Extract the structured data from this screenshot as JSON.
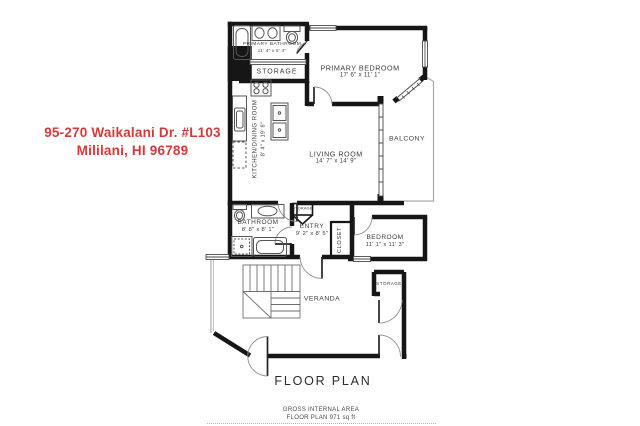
{
  "canvas": {
    "width": 640,
    "height": 426,
    "background": "#ffffff"
  },
  "address": {
    "line1": "95-270 Waikalani Dr. #L103",
    "line2": "Mililani, HI 96789",
    "color": "#d23b3b"
  },
  "plan_title": "FLOOR PLAN",
  "footer": {
    "line1": "GROSS INTERNAL AREA",
    "line2": "FLOOR PLAN 971 sq ft"
  },
  "colors": {
    "wall": "#161616",
    "fixture_stroke": "#555555",
    "label_text": "#3c3c3c",
    "address_red": "#d23b3b"
  },
  "rooms": [
    {
      "name": "PRIMARY BATHROOM",
      "dims": "11' 4\" x 5' 4\""
    },
    {
      "name": "STORAGE",
      "dims": ""
    },
    {
      "name": "PRIMARY BEDROOM",
      "dims": "17' 6\" x 11' 1\""
    },
    {
      "name": "KITCHEN/DINING ROOM",
      "dims": "8' 4\" x 19' 8\""
    },
    {
      "name": "LIVING ROOM",
      "dims": "14' 7\" x 14' 9\""
    },
    {
      "name": "BALCONY",
      "dims": ""
    },
    {
      "name": "BATHROOM",
      "dims": "8' 8\" x 8' 1\""
    },
    {
      "name": "ENTRY",
      "dims": "9' 2\" x 8' 5\""
    },
    {
      "name": "CLOSET",
      "dims": ""
    },
    {
      "name": "BEDROOM",
      "dims": "11' 1\" x 11' 3\""
    },
    {
      "name": "VERANDA",
      "dims": ""
    },
    {
      "name": "STORAGE",
      "dims": ""
    },
    {
      "name": "STORAGE",
      "dims": ""
    }
  ]
}
